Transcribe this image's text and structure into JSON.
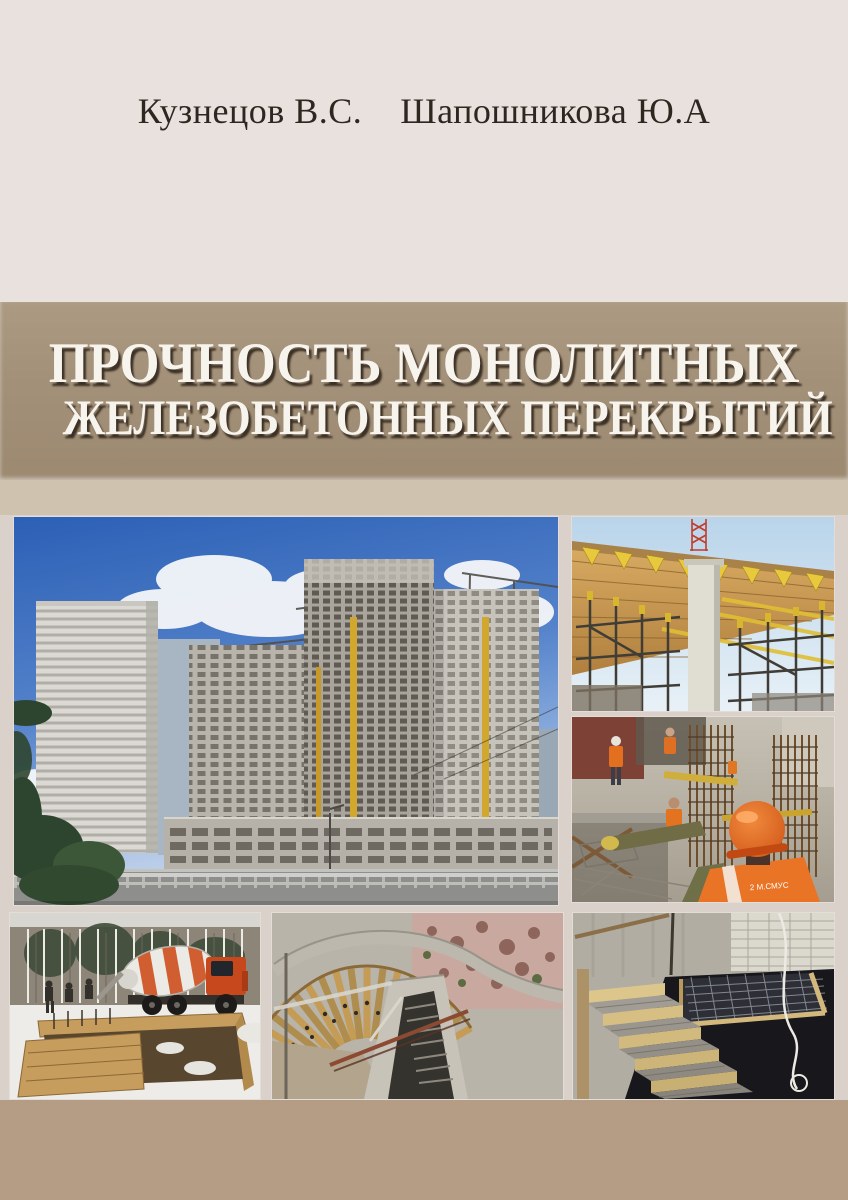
{
  "cover": {
    "authors": [
      "Кузнецов В.С.",
      "Шапошникова Ю.А"
    ],
    "title_line1": "ПРОЧНОСТЬ МОНОЛИТНЫХ",
    "title_line2": "ЖЕЛЕЗОБЕТОННЫХ ПЕРЕКРЫТИЙ"
  },
  "photos": [
    {
      "name": "construction-panorama",
      "description": "Panorama of monolithic high-rise buildings under construction with tower cranes"
    },
    {
      "name": "slab-formwork",
      "description": "Slab formwork deck with yellow timber joists, concrete column and shoring scaffold"
    },
    {
      "name": "workers-rebar",
      "description": "Workers in orange vests and hard hats assembling rebar cages"
    },
    {
      "name": "winter-concreting",
      "description": "Concrete mixer truck and timber foundation formwork on a snowy site"
    },
    {
      "name": "curved-wall-formwork",
      "description": "Curved timber wall formwork with stair flight and walkway"
    },
    {
      "name": "stair-concreting",
      "description": "Freshly cast concrete stair with timber edge boards above a dark pit"
    }
  ],
  "colors": {
    "background": "#e8e1dd",
    "title_band": "#a4917a",
    "title_band_light": "#cfc3b0",
    "bottom_band": "#b49d84",
    "title_text": "#f7f4ee",
    "author_text": "#2e2720"
  }
}
